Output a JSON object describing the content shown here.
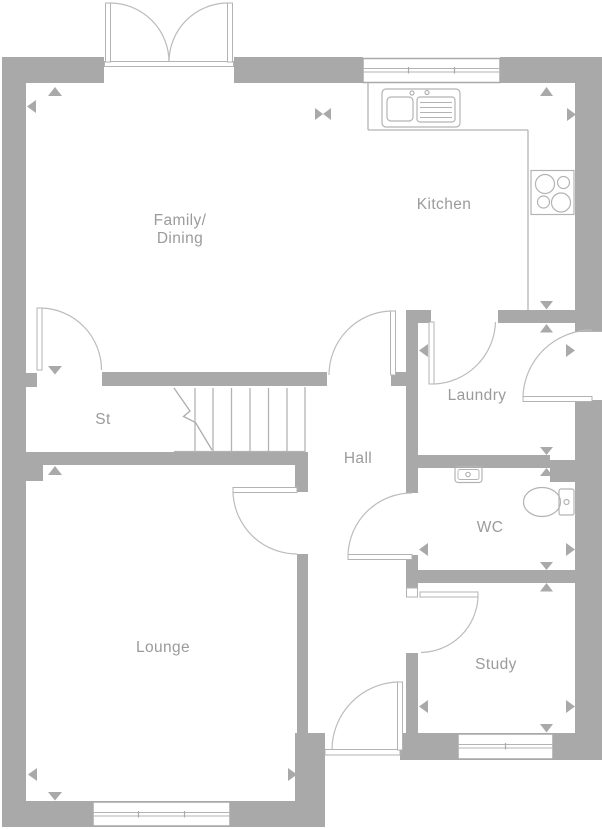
{
  "rooms": {
    "family_dining": {
      "line1": "Family/",
      "line2": "Dining"
    },
    "kitchen": {
      "label": "Kitchen"
    },
    "store": {
      "label": "St"
    },
    "hall": {
      "label": "Hall"
    },
    "laundry": {
      "label": "Laundry"
    },
    "wc": {
      "label": "WC"
    },
    "lounge": {
      "label": "Lounge"
    },
    "study": {
      "label": "Study"
    }
  },
  "colors": {
    "wall": "#a9a9a9",
    "thin_line": "#b3b3b3",
    "door_arc": "#bcbcbc",
    "label_text": "#9b9b9b",
    "background": "#ffffff"
  },
  "fixtures": [
    "double-entrance-door",
    "kitchen-window",
    "kitchen-sink",
    "hob",
    "worktop",
    "staircase",
    "toilet",
    "wash-basin",
    "lounge-window",
    "study-window",
    "side-door",
    "back-door"
  ]
}
